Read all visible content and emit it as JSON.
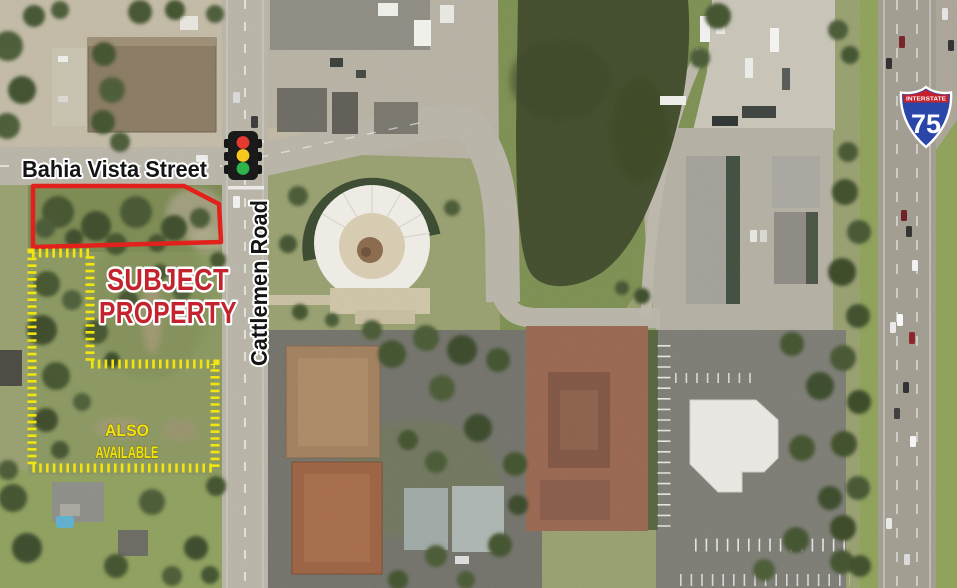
{
  "map": {
    "streets": {
      "bahia_vista": "Bahia Vista Street",
      "cattlemen": "Cattlemen Road"
    },
    "annotations": {
      "subject_property": {
        "line1": "SUBJECT",
        "line2": "PROPERTY"
      },
      "also_available": {
        "line1": "ALSO",
        "line2": "AVAILABLE"
      }
    },
    "interstate_shield": {
      "banner": "INTERSTATE",
      "route_number": "75"
    },
    "colors": {
      "subject_outline": "#e2211c",
      "subject_text": "#c4232e",
      "available_outline": "#f2e50f",
      "available_text": "#f2e20c",
      "traffic_red": "#e43a30",
      "traffic_yellow": "#f8c81f",
      "traffic_green": "#2db44a",
      "shield_blue": "#2a46a8",
      "shield_red": "#c6202e"
    }
  }
}
